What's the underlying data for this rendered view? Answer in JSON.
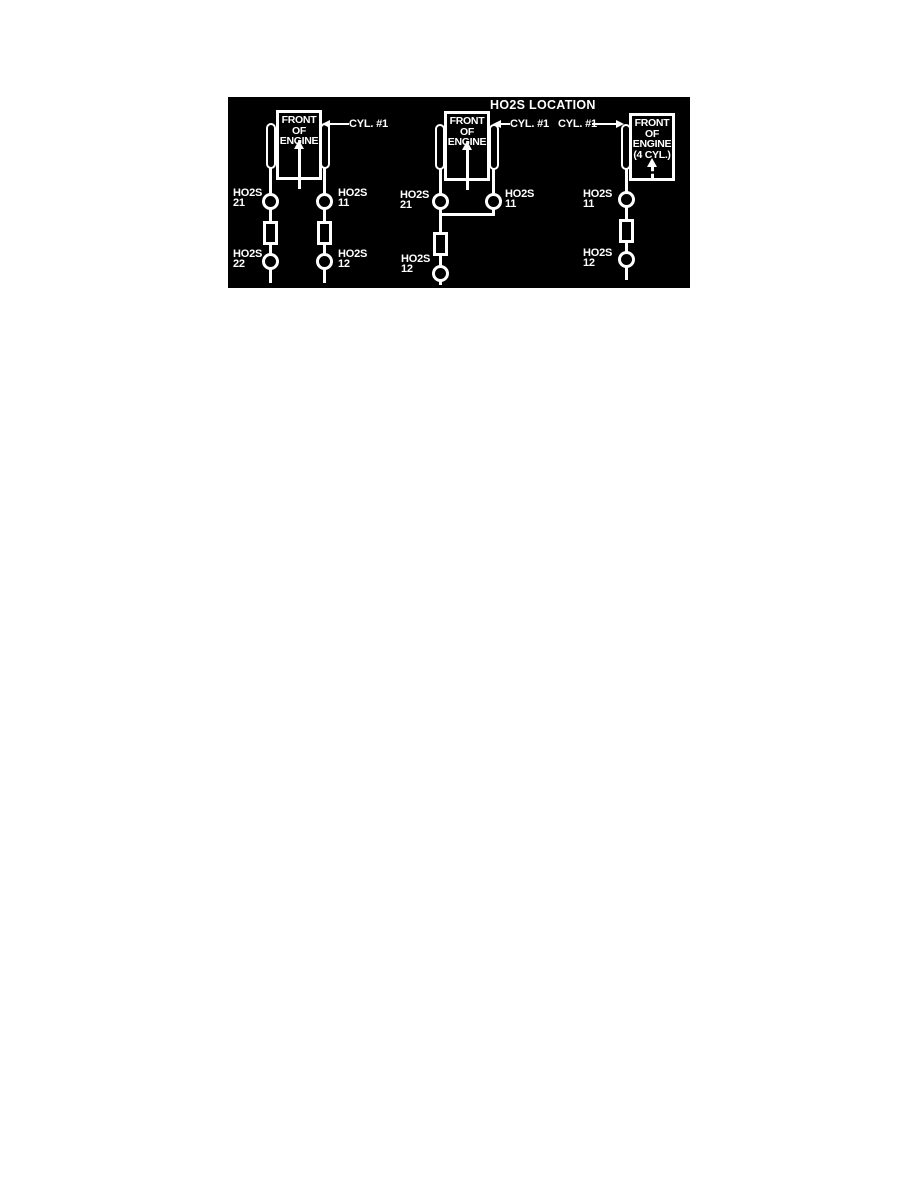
{
  "figure": {
    "title": "HO2S LOCATION",
    "colors": {
      "panel_background": "#000000",
      "line_art": "#ffffff",
      "page_background": "#ffffff"
    },
    "diagrams": [
      {
        "id": "v-engine-dual-exhaust",
        "engine_label": "FRONT\nOF\nENGINE",
        "cyl_label": "CYL. #1",
        "sensor_21": "HO2S\n21",
        "sensor_11": "HO2S\n11",
        "sensor_22": "HO2S\n22",
        "sensor_12": "HO2S\n12"
      },
      {
        "id": "v-engine-single-exhaust",
        "engine_label": "FRONT\nOF\nENGINE",
        "cyl_label": "CYL. #1",
        "sensor_21": "HO2S\n21",
        "sensor_11": "HO2S\n11",
        "sensor_12": "HO2S\n12"
      },
      {
        "id": "four-cylinder-engine",
        "engine_label": "FRONT\nOF\nENGINE\n(4 CYL.)",
        "cyl_label": "CYL. #1",
        "sensor_11": "HO2S\n11",
        "sensor_12": "HO2S\n12"
      }
    ]
  }
}
